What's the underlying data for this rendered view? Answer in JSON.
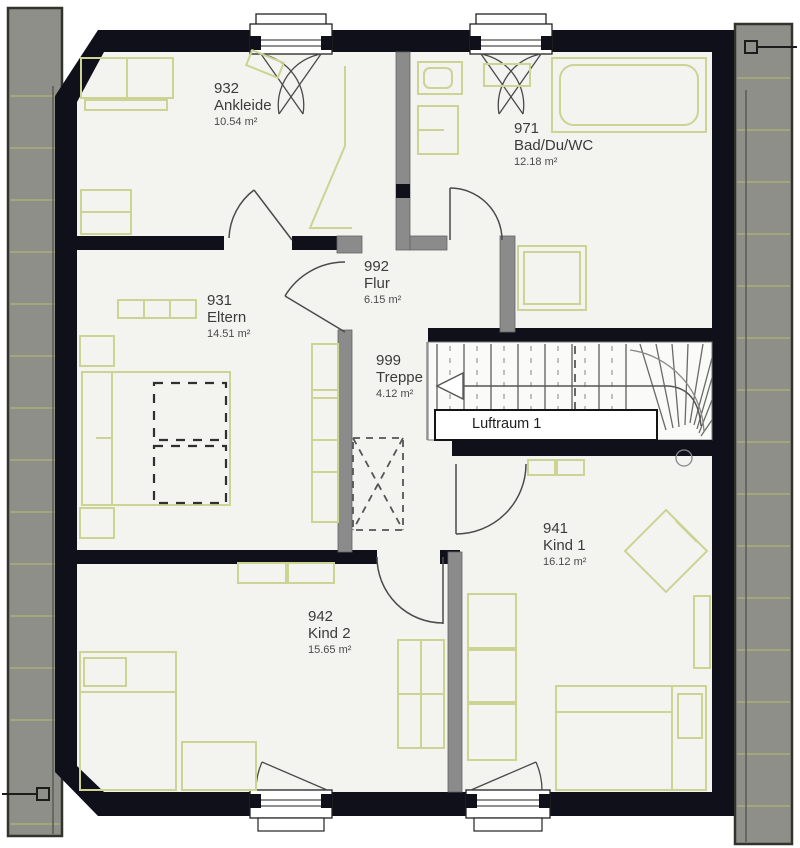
{
  "rooms": [
    {
      "number": "932",
      "name": "Ankleide",
      "area": "10.54 m²"
    },
    {
      "number": "971",
      "name": "Bad/Du/WC",
      "area": "12.18 m²"
    },
    {
      "number": "931",
      "name": "Eltern",
      "area": "14.51 m²"
    },
    {
      "number": "992",
      "name": "Flur",
      "area": "6.15 m²"
    },
    {
      "number": "999",
      "name": "Treppe",
      "area": "4.12 m²"
    },
    {
      "number": "941",
      "name": "Kind 1",
      "area": "16.12 m²"
    },
    {
      "number": "942",
      "name": "Kind 2",
      "area": "15.65 m²"
    }
  ],
  "void_label": "Luftraum 1",
  "colors": {
    "wall": "#10101a",
    "partition": "#8b8b8b",
    "floor": "#f3f3f0",
    "roof_strip": "#8f8f89",
    "roof_line": "#a9ae76",
    "furniture": "#cdd393",
    "text": "#3b3b3b"
  }
}
